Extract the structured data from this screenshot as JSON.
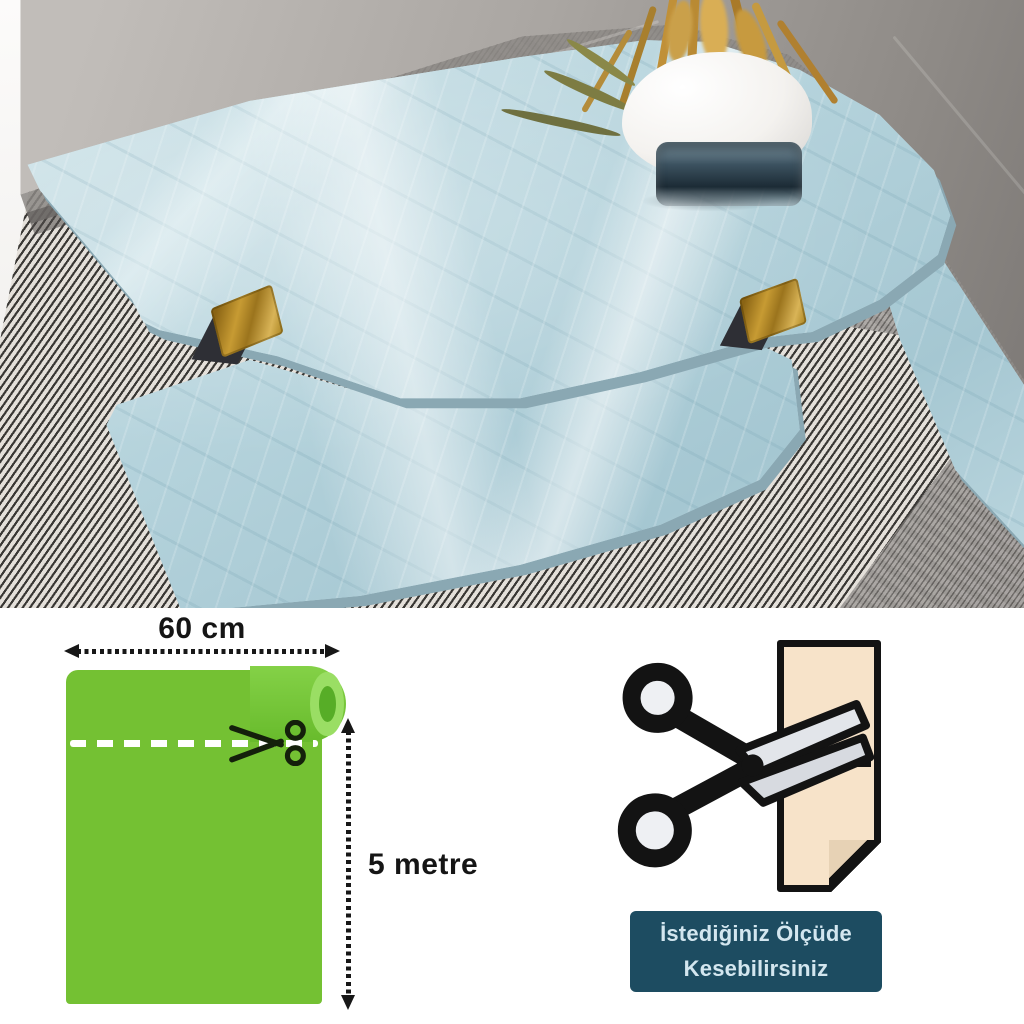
{
  "diagram": {
    "width_label": "60 cm",
    "length_label": "5 metre"
  },
  "cut_badge": {
    "line1": "İstediğiniz Ölçüde",
    "line2": "Kesebilirsiniz"
  },
  "colors": {
    "roll_green": "#74c133",
    "badge_background": "#1d4c61",
    "badge_text": "#d3e6ef",
    "marble_blue": "#bdd9e1",
    "gold_bracket": "#c79b33",
    "paper_beige": "#f7e3c9"
  }
}
